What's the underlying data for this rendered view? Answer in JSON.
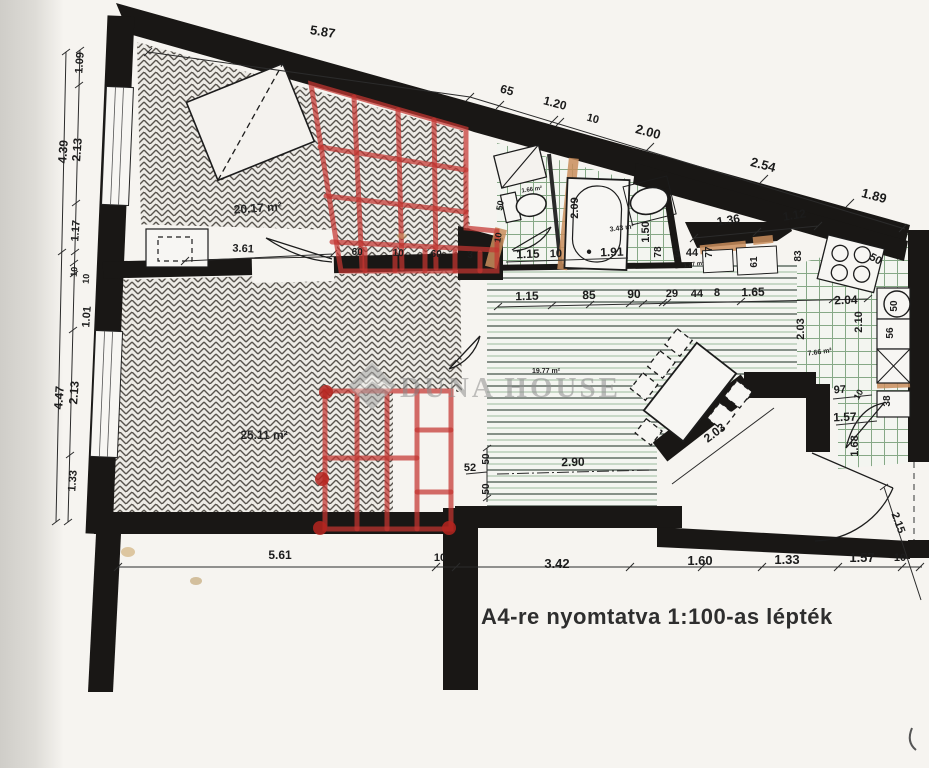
{
  "document": {
    "kind": "scanned apartment floor plan",
    "footer": {
      "scale_note": "A4-re nyomtatva 1:100-as lépték"
    },
    "watermark": {
      "text": "DUNA HOUSE"
    }
  },
  "palette": {
    "wall": "#191715",
    "red_marker": "#c43530",
    "tile_green": "#86a886",
    "lintel_tan": "#c98d5c",
    "paper": "#f6f4f0"
  },
  "rooms": [
    {
      "label": "20.17 m²",
      "x": 258,
      "y": 212,
      "r": -4,
      "s": 12
    },
    {
      "label": "25.11 m²",
      "x": 264,
      "y": 439,
      "r": 0,
      "s": 12
    },
    {
      "label": "19.77 m²",
      "x": 546,
      "y": 373,
      "r": 0,
      "s": 7
    },
    {
      "label": "7.66 m²",
      "x": 820,
      "y": 354,
      "r": -8,
      "s": 7
    },
    {
      "label": "3.43 m²",
      "x": 622,
      "y": 230,
      "r": -8,
      "s": 7
    },
    {
      "label": "1.66 m²",
      "x": 532,
      "y": 191,
      "r": -8,
      "s": 6
    },
    {
      "label": "1.27 m²",
      "x": 694,
      "y": 266,
      "r": -8,
      "s": 6
    }
  ],
  "dimensions": [
    {
      "t": "5.87",
      "x": 322,
      "y": 36,
      "r": 9,
      "s": 13
    },
    {
      "t": "65",
      "x": 506,
      "y": 94,
      "r": 15,
      "s": 12
    },
    {
      "t": "1.20",
      "x": 554,
      "y": 107,
      "r": 15,
      "s": 12
    },
    {
      "t": "10",
      "x": 592,
      "y": 122,
      "r": 15,
      "s": 11
    },
    {
      "t": "2.00",
      "x": 647,
      "y": 136,
      "r": 15,
      "s": 13
    },
    {
      "t": "2.54",
      "x": 762,
      "y": 169,
      "r": 15,
      "s": 13
    },
    {
      "t": "1.89",
      "x": 873,
      "y": 200,
      "r": 15,
      "s": 13
    },
    {
      "t": "1.09",
      "x": 83,
      "y": 63,
      "r": -86,
      "s": 11
    },
    {
      "t": "4.39",
      "x": 67,
      "y": 152,
      "r": -86,
      "s": 12
    },
    {
      "t": "2.13",
      "x": 81,
      "y": 150,
      "r": -86,
      "s": 12
    },
    {
      "t": "1.17",
      "x": 79,
      "y": 231,
      "r": -86,
      "s": 11
    },
    {
      "t": "10",
      "x": 77,
      "y": 272,
      "r": -86,
      "s": 9
    },
    {
      "t": "10",
      "x": 89,
      "y": 279,
      "r": -86,
      "s": 9
    },
    {
      "t": "1.01",
      "x": 90,
      "y": 317,
      "r": -86,
      "s": 11
    },
    {
      "t": "4.47",
      "x": 63,
      "y": 398,
      "r": -86,
      "s": 12
    },
    {
      "t": "2.13",
      "x": 78,
      "y": 393,
      "r": -86,
      "s": 12
    },
    {
      "t": "1.33",
      "x": 76,
      "y": 481,
      "r": -86,
      "s": 11
    },
    {
      "t": "1.15",
      "x": 527,
      "y": 300,
      "r": -1,
      "s": 12
    },
    {
      "t": "85",
      "x": 589,
      "y": 299,
      "r": -1,
      "s": 12
    },
    {
      "t": "90",
      "x": 634,
      "y": 298,
      "r": -1,
      "s": 12
    },
    {
      "t": "29",
      "x": 672,
      "y": 297,
      "r": -1,
      "s": 11
    },
    {
      "t": "44",
      "x": 697,
      "y": 297,
      "r": -1,
      "s": 11
    },
    {
      "t": "8",
      "x": 717,
      "y": 296,
      "r": -1,
      "s": 11
    },
    {
      "t": "1.65",
      "x": 753,
      "y": 296,
      "r": -1,
      "s": 12
    },
    {
      "t": "2.04",
      "x": 846,
      "y": 304,
      "r": -2,
      "s": 12
    },
    {
      "t": "1.15",
      "x": 528,
      "y": 258,
      "r": -2,
      "s": 12
    },
    {
      "t": "10",
      "x": 556,
      "y": 257,
      "r": -2,
      "s": 11
    },
    {
      "t": "1.91",
      "x": 612,
      "y": 256,
      "r": -2,
      "s": 12
    },
    {
      "t": "2.09",
      "x": 578,
      "y": 208,
      "r": -90,
      "s": 11
    },
    {
      "t": "1.50",
      "x": 649,
      "y": 232,
      "r": -90,
      "s": 11
    },
    {
      "t": "78",
      "x": 661,
      "y": 252,
      "r": -90,
      "s": 10
    },
    {
      "t": "3",
      "x": 677,
      "y": 257,
      "r": 0,
      "s": 11
    },
    {
      "t": "44",
      "x": 692,
      "y": 256,
      "r": 0,
      "s": 11
    },
    {
      "t": "50",
      "x": 503,
      "y": 206,
      "r": -80,
      "s": 9
    },
    {
      "t": "10",
      "x": 501,
      "y": 238,
      "r": -80,
      "s": 9
    },
    {
      "t": "1.36",
      "x": 729,
      "y": 224,
      "r": -9,
      "s": 12
    },
    {
      "t": "1.12",
      "x": 795,
      "y": 219,
      "r": -9,
      "s": 12
    },
    {
      "t": "77",
      "x": 712,
      "y": 252,
      "r": -90,
      "s": 10
    },
    {
      "t": "61",
      "x": 757,
      "y": 262,
      "r": -90,
      "s": 10
    },
    {
      "t": "83",
      "x": 801,
      "y": 256,
      "r": -90,
      "s": 10
    },
    {
      "t": "50",
      "x": 874,
      "y": 262,
      "r": 28,
      "s": 11
    },
    {
      "t": "2.10",
      "x": 862,
      "y": 322,
      "r": -90,
      "s": 11
    },
    {
      "t": "2.03",
      "x": 804,
      "y": 329,
      "r": -90,
      "s": 11
    },
    {
      "t": "50",
      "x": 897,
      "y": 306,
      "r": -90,
      "s": 10
    },
    {
      "t": "56",
      "x": 893,
      "y": 333,
      "r": -90,
      "s": 10
    },
    {
      "t": "38",
      "x": 890,
      "y": 401,
      "r": -90,
      "s": 10
    },
    {
      "t": "97",
      "x": 840,
      "y": 393,
      "r": -3,
      "s": 11
    },
    {
      "t": "10",
      "x": 861,
      "y": 396,
      "r": -60,
      "s": 9
    },
    {
      "t": "1.57",
      "x": 845,
      "y": 421,
      "r": -2,
      "s": 12
    },
    {
      "t": "1.68",
      "x": 858,
      "y": 446,
      "r": -90,
      "s": 11
    },
    {
      "t": "2.03",
      "x": 717,
      "y": 436,
      "r": -37,
      "s": 12
    },
    {
      "t": "2.90",
      "x": 573,
      "y": 466,
      "r": -1,
      "s": 12
    },
    {
      "t": "52",
      "x": 470,
      "y": 471,
      "r": 0,
      "s": 11
    },
    {
      "t": "50",
      "x": 489,
      "y": 459,
      "r": -90,
      "s": 10
    },
    {
      "t": "50",
      "x": 489,
      "y": 489,
      "r": -90,
      "s": 10
    },
    {
      "t": "2.15",
      "x": 895,
      "y": 524,
      "r": 70,
      "s": 11
    },
    {
      "t": "5.61",
      "x": 280,
      "y": 559,
      "r": 0,
      "s": 12
    },
    {
      "t": "10",
      "x": 440,
      "y": 561,
      "r": 0,
      "s": 11
    },
    {
      "t": "3.42",
      "x": 557,
      "y": 568,
      "r": 0,
      "s": 13
    },
    {
      "t": "1.60",
      "x": 700,
      "y": 565,
      "r": 0,
      "s": 13
    },
    {
      "t": "1.33",
      "x": 787,
      "y": 564,
      "r": 0,
      "s": 13
    },
    {
      "t": "1.57",
      "x": 862,
      "y": 562,
      "r": 0,
      "s": 13
    },
    {
      "t": "10",
      "x": 900,
      "y": 561,
      "r": 0,
      "s": 11
    },
    {
      "t": "3.61",
      "x": 243,
      "y": 252,
      "r": 3,
      "s": 11
    },
    {
      "t": "60",
      "x": 357,
      "y": 255,
      "r": 3,
      "s": 10
    },
    {
      "t": "10",
      "x": 398,
      "y": 256,
      "r": 3,
      "s": 10
    },
    {
      "t": "60",
      "x": 436,
      "y": 257,
      "r": 3,
      "s": 10
    },
    {
      "t": "3",
      "x": 470,
      "y": 258,
      "r": 3,
      "s": 10
    }
  ]
}
